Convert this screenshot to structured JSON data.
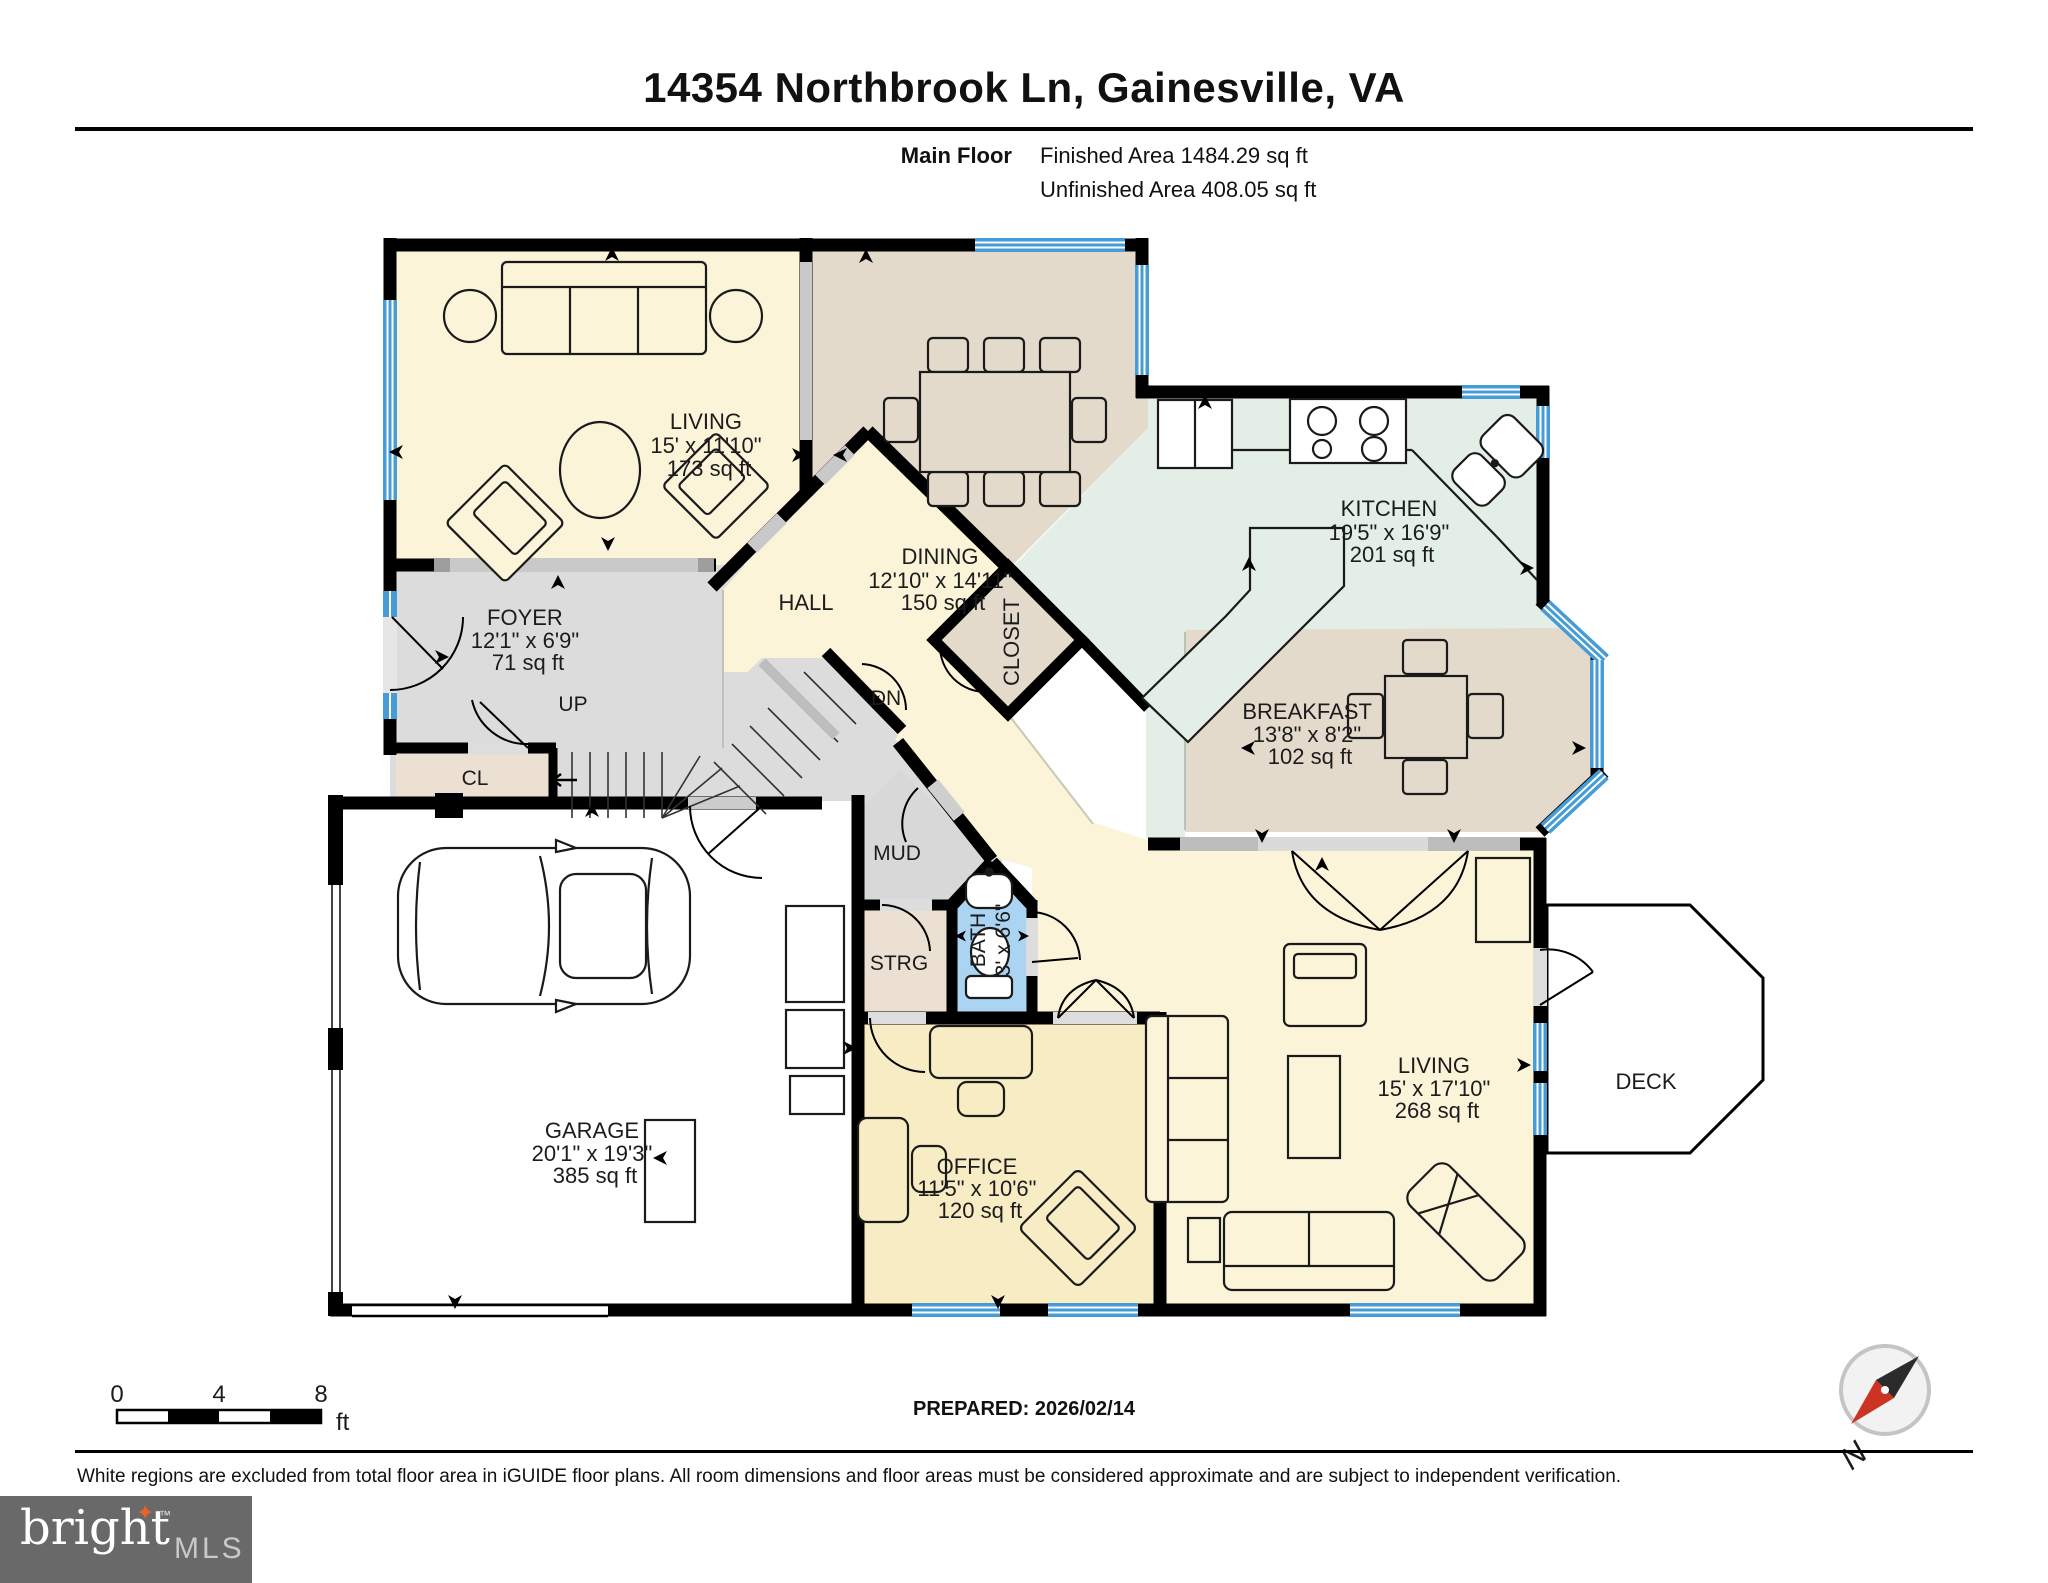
{
  "header": {
    "title": "14354 Northbrook Ln, Gainesville, VA",
    "floor_label": "Main Floor",
    "finished_area": "Finished Area 1484.29 sq ft",
    "unfinished_area": "Unfinished Area 408.05 sq ft"
  },
  "rooms": {
    "living_tl": {
      "name": "LIVING",
      "dims": "15' x 11'10\"",
      "area": "173 sq ft"
    },
    "dining": {
      "name": "DINING",
      "dims": "12'10\" x 14'11\"",
      "area": "150 sq ft"
    },
    "kitchen": {
      "name": "KITCHEN",
      "dims": "19'5\" x 16'9\"",
      "area": "201 sq ft"
    },
    "breakfast": {
      "name": "BREAKFAST",
      "dims": "13'8\" x 8'2\"",
      "area": "102 sq ft"
    },
    "foyer": {
      "name": "FOYER",
      "dims": "12'1\" x 6'9\"",
      "area": "71 sq ft"
    },
    "hall": {
      "name": "HALL"
    },
    "closet": {
      "name": "CLOSET"
    },
    "cl": {
      "name": "CL"
    },
    "up": {
      "name": "UP"
    },
    "dn": {
      "name": "DN"
    },
    "mud": {
      "name": "MUD"
    },
    "strg": {
      "name": "STRG"
    },
    "bath": {
      "name": "BATH",
      "dims": "3' x 6'6\""
    },
    "garage": {
      "name": "GARAGE",
      "dims": "20'1\" x 19'3\"",
      "area": "385 sq ft"
    },
    "office": {
      "name": "OFFICE",
      "dims": "11'5\" x 10'6\"",
      "area": "120 sq ft"
    },
    "living_r": {
      "name": "LIVING",
      "dims": "15' x 17'10\"",
      "area": "268 sq ft"
    },
    "deck": {
      "name": "DECK"
    }
  },
  "scale_bar": {
    "t0": "0",
    "t4": "4",
    "t8": "8",
    "unit": "ft"
  },
  "compass": {
    "north": "N"
  },
  "footer": {
    "prepared": "PREPARED: 2026/02/14",
    "disclaimer": "White regions are excluded from total floor area in iGUIDE floor plans. All room dimensions and floor areas must be considered approximate and are subject to independent verification."
  },
  "logo": {
    "brand": "bright",
    "star": "✦",
    "tm": "™",
    "mls": "MLS"
  },
  "colors": {
    "cream": "#FCF4D9",
    "office_yellow": "#F7ECC4",
    "tan": "#E4DACB",
    "beige": "#EBE0D2",
    "green": "#E2EEE6",
    "gray_floor": "#DCDCDC",
    "bath_blue": "#AAD4F2",
    "window_blue": "#459CD6",
    "wall": "#000000",
    "logo_bg": "#696969",
    "logo_star": "#E8622A"
  }
}
